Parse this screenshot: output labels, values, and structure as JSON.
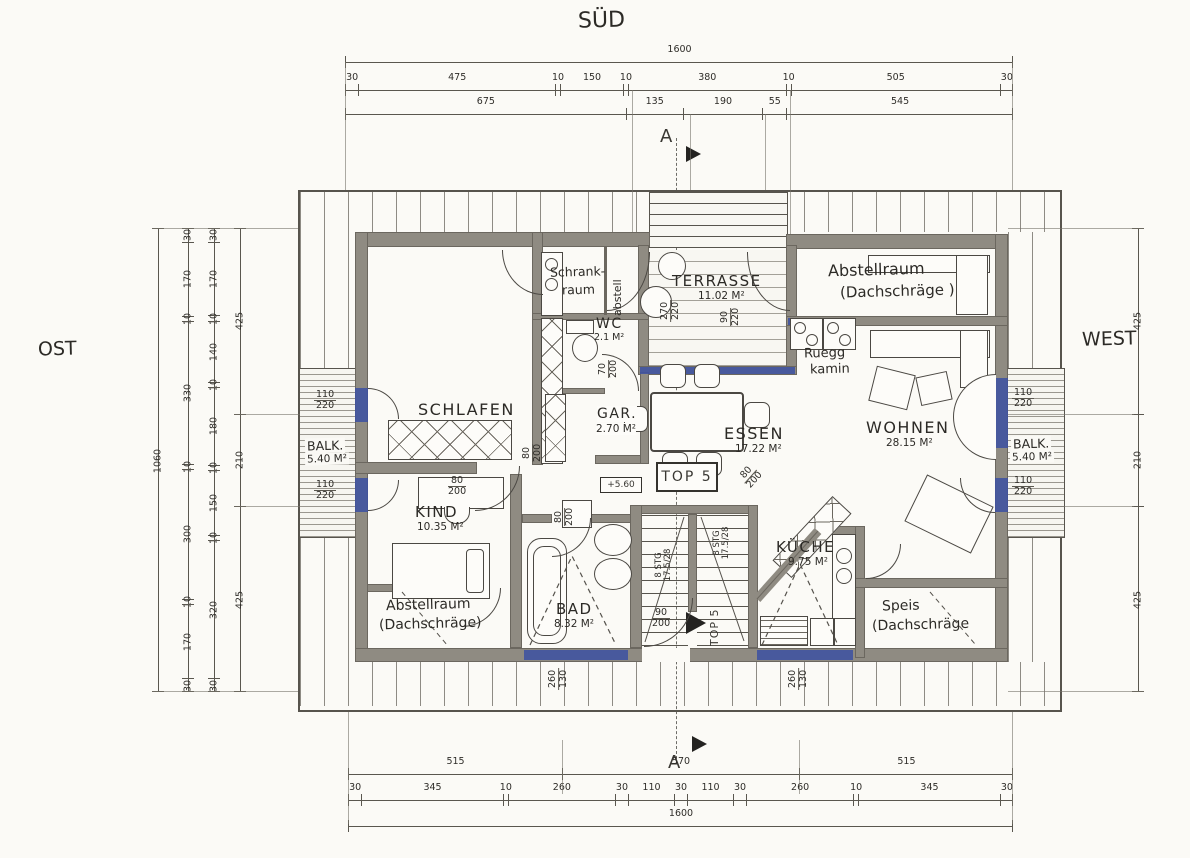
{
  "title_labels": {
    "south": "SÜD",
    "east": "OST",
    "west": "WEST",
    "section_top": "A",
    "section_bottom": "A"
  },
  "unit": {
    "box_label": "TOP 5",
    "entrance_label": "TOP 5",
    "elevation": "+5.60"
  },
  "rooms": {
    "terrasse": {
      "name": "TERRASSE",
      "area": "11.02 M²"
    },
    "abstellraum_nord": {
      "name": "Abstellraum",
      "note": "(Dachschräge )"
    },
    "schrankraum": {
      "line1": "Schrank-",
      "line2": "raum"
    },
    "abstell": {
      "name": "abstell"
    },
    "wc": {
      "name": "WC",
      "area": "2.1 M²"
    },
    "schlafen": {
      "name": "SCHLAFEN"
    },
    "gar": {
      "name": "GAR.",
      "area": "2.70 M²"
    },
    "essen": {
      "name": "ESSEN",
      "area": "17.22 M²"
    },
    "wohnen": {
      "name": "WOHNEN",
      "area": "28.15 M²"
    },
    "kamin": {
      "line1": "Ruegg",
      "line2": "kamin"
    },
    "balk_ost": {
      "name": "BALK.",
      "area": "5.40 M²"
    },
    "balk_west": {
      "name": "BALK.",
      "area": "5.40 M²"
    },
    "kind": {
      "name": "KIND",
      "area": "10.35 M²"
    },
    "bad": {
      "name": "BAD",
      "area": "8.32 M²"
    },
    "kueche": {
      "name": "KÜCHE",
      "area": "9.75 M²"
    },
    "abstellraum_sued": {
      "name": "Abstellraum",
      "note": "(Dachschräge)"
    },
    "speis": {
      "name": "Speis",
      "note": "(Dachschräge"
    }
  },
  "stairs": {
    "line1": "8 STG",
    "line2": "17.5/28"
  },
  "opening_dims": {
    "balk_window": {
      "n": "110",
      "d": "220"
    },
    "terrace_door": {
      "n": "270",
      "d": "220"
    },
    "terrace_window": {
      "n": "90",
      "d": "220"
    },
    "wc_door": {
      "n": "70",
      "d": "200"
    },
    "schlafen_door": {
      "n": "80",
      "d": "200"
    },
    "hall_door": {
      "n": "80",
      "d": "200"
    },
    "bad_door": {
      "n": "80",
      "d": "200"
    },
    "kitchen_door": {
      "n": "80",
      "d": "200"
    },
    "entry_door": {
      "n": "90",
      "d": "200"
    },
    "south_window": {
      "n": "260",
      "d": "130"
    }
  },
  "dim_chains": {
    "top_total": [
      1600
    ],
    "top_detail": [
      30,
      475,
      10,
      150,
      10,
      380,
      10,
      505,
      30
    ],
    "top_sub": [
      675,
      135,
      190,
      55,
      545
    ],
    "bottom_main": [
      515,
      570,
      515
    ],
    "bottom_detail": [
      30,
      345,
      10,
      260,
      30,
      110,
      30,
      110,
      30,
      260,
      10,
      345,
      30
    ],
    "bottom_total": [
      1600
    ],
    "left_total": [
      1060
    ],
    "left_chain1": [
      30,
      170,
      10,
      330,
      10,
      300,
      10,
      170,
      30
    ],
    "left_chain2": [
      30,
      170,
      10,
      140,
      10,
      180,
      10,
      150,
      10,
      320,
      30
    ],
    "left_chain3": [
      425,
      210,
      425
    ],
    "right_chain": [
      425,
      210,
      425
    ]
  }
}
